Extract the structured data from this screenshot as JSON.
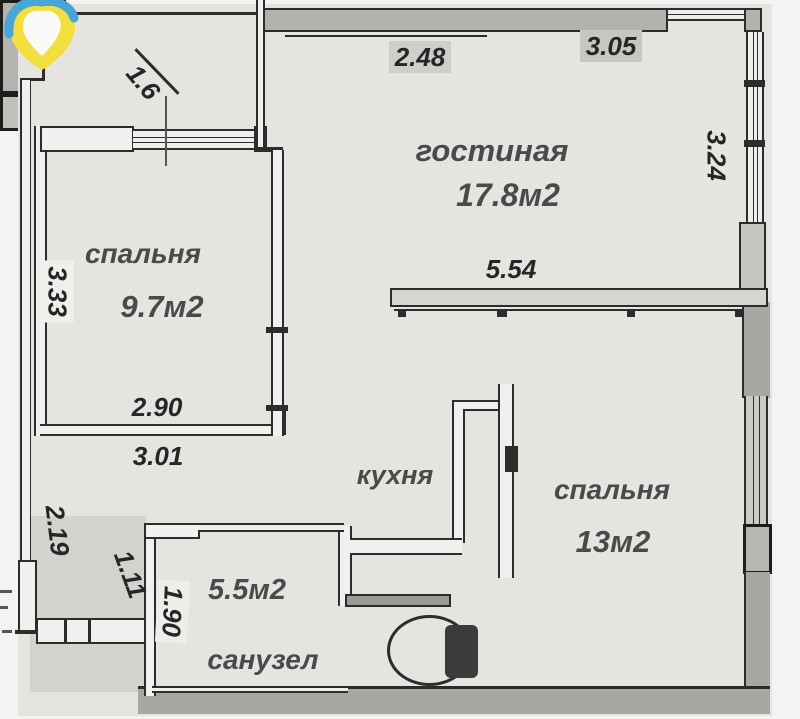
{
  "title": "apartment-floor-plan",
  "rooms": [
    {
      "name": "гостиная",
      "area": "17.8м2"
    },
    {
      "name": "спальня",
      "area": "9.7м2"
    },
    {
      "name": "спальня",
      "area": "13м2"
    },
    {
      "name": "кухня"
    },
    {
      "name": "санузел",
      "area": "5.5м2"
    }
  ],
  "dimensions": {
    "hall_top": "1.6",
    "living_top_left": "2.48",
    "living_top_right": "3.05",
    "living_right": "3.24",
    "bedroom1_left": "3.33",
    "living_bottom": "5.54",
    "bedroom1_bottom": "2.90",
    "corridor_bottom": "3.01",
    "corridor_left": "2.19",
    "corridor_width": "1.11",
    "bathroom_left": "1.90"
  },
  "icons": {
    "logo": "location-pin-logo",
    "toilet": "toilet-symbol"
  },
  "colors": {
    "logo_yellow": "#f2df3e",
    "logo_blue": "#49a5d6",
    "wall_dark": "#2c2c2a",
    "wall_gray": "#a8a7a4",
    "floor": "#e5e4e1"
  }
}
